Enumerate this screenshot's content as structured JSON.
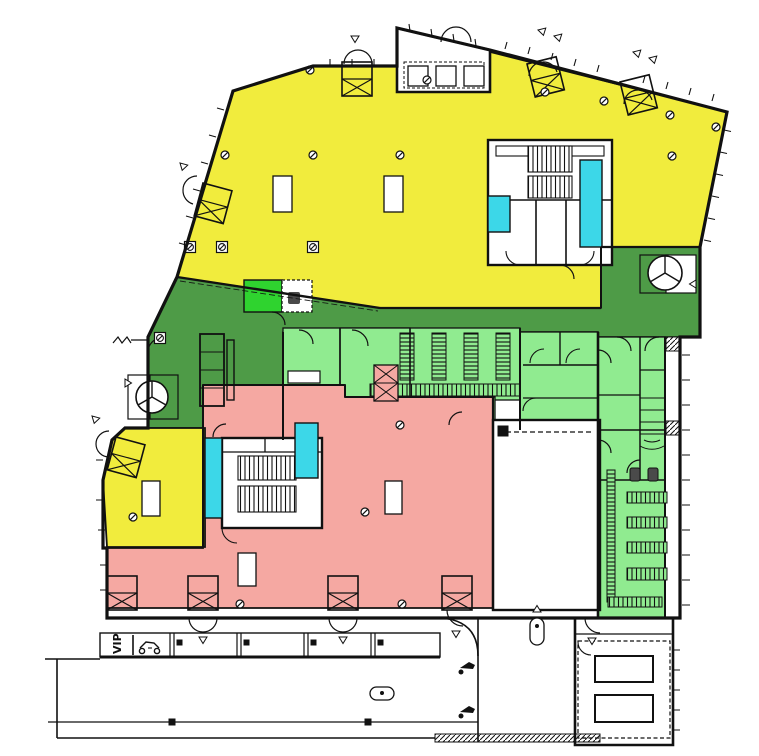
{
  "title": "building-ground-floor-plan",
  "labels": {
    "vip_parking": "VIP"
  },
  "colors": {
    "yellow": "#F1EC3D",
    "dark_green": "#4E9B47",
    "light_green": "#90EB90",
    "bright_green": "#2FD32F",
    "pink": "#F5A8A2",
    "cyan": "#3CD7E8",
    "wall": "#111111",
    "paper": "#FFFFFF",
    "fixture_gray": "#4a4a4a"
  },
  "zones": [
    {
      "id": "upper-hall",
      "color_key": "yellow"
    },
    {
      "id": "west-room",
      "color_key": "yellow"
    },
    {
      "id": "entrance-lobby",
      "color_key": "dark_green"
    },
    {
      "id": "service-and-cloakroom",
      "color_key": "light_green"
    },
    {
      "id": "lower-hall",
      "color_key": "pink"
    },
    {
      "id": "elevator-shafts",
      "color_key": "cyan"
    },
    {
      "id": "utility-room",
      "color_key": "bright_green"
    }
  ]
}
